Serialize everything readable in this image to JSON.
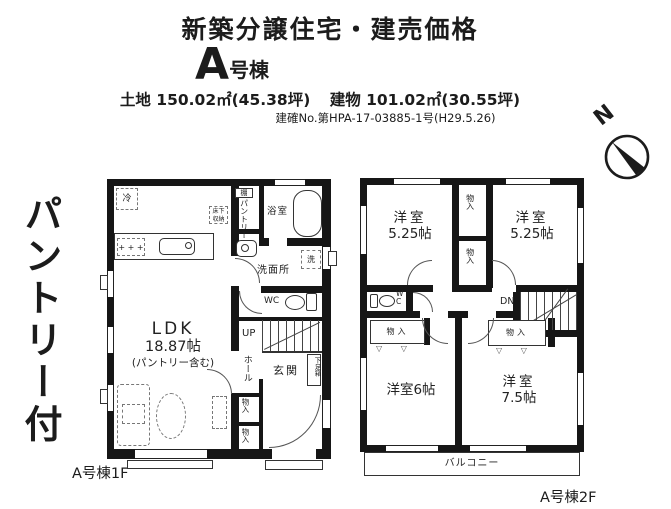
{
  "header": {
    "title": "新築分譲住宅・建売価格",
    "building_letter": "A",
    "building_suffix": "号棟",
    "land_area": "土地 150.02㎡(45.38坪)",
    "building_area": "建物 101.02㎡(30.55坪)",
    "permit_no": "建確No.第HPA-17-03885-1号(H29.5.26)"
  },
  "side_note": "パントリー付",
  "compass_n": "N",
  "floor1": {
    "caption": "A号棟1F",
    "ldk_name": "LDK",
    "ldk_size": "18.87帖",
    "ldk_note": "(パントリー含む)",
    "fridge": "冷",
    "underfloor_storage": "床下収納",
    "shelf": "棚",
    "pantry": "パントリー",
    "bathroom": "浴室",
    "washroom": "洗面所",
    "washer": "洗",
    "wc": "WC",
    "up": "UP",
    "hall": "ホール",
    "entrance": "玄関",
    "shoe_box": "下足箱",
    "storage": "物入"
  },
  "floor2": {
    "caption": "A号棟2F",
    "room_nw_name": "洋室",
    "room_nw_size": "5.25帖",
    "room_ne_name": "洋室",
    "room_ne_size": "5.25帖",
    "room_sw": "洋室6帖",
    "room_se_name": "洋室",
    "room_se_size": "7.5帖",
    "wc": "WC",
    "dn": "DN",
    "storage": "物入",
    "balcony": "バルコニー",
    "closet_door_mark": "▽  ▽"
  },
  "icons": {
    "stove_burners": "+ + +"
  }
}
